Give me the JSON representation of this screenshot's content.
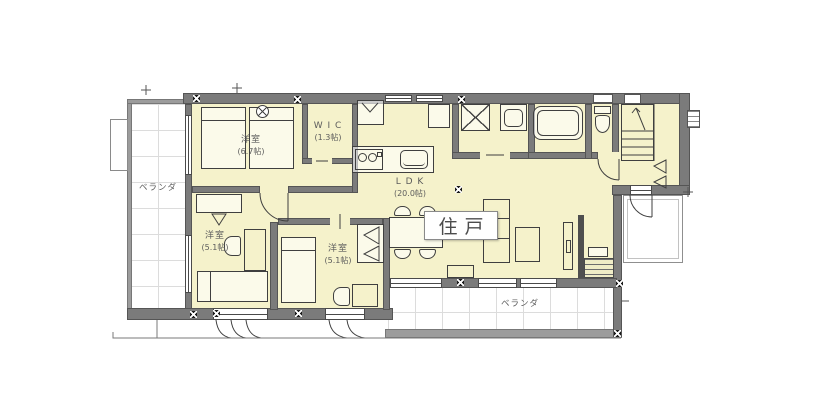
{
  "floor_plan": {
    "unit_label": "住戸",
    "rooms": {
      "bedroom_main": {
        "name": "洋室",
        "size": "(6.7帖)"
      },
      "wic": {
        "name": "W I C",
        "size": "(1.3帖)"
      },
      "ldk": {
        "name": "L D K",
        "size": "(20.0帖)"
      },
      "bedroom_west": {
        "name": "洋室",
        "size": "(5.1帖)"
      },
      "bedroom_south": {
        "name": "洋室",
        "size": "(5.1帖)"
      },
      "veranda_west": {
        "name": "ベランダ"
      },
      "veranda_south": {
        "name": "ベランダ"
      }
    },
    "colors": {
      "room_fill": "#f5f2cb",
      "wall": "#7b7b7b",
      "veranda_wall": "#9c9c9c",
      "outline": "#3f3f3f"
    }
  }
}
